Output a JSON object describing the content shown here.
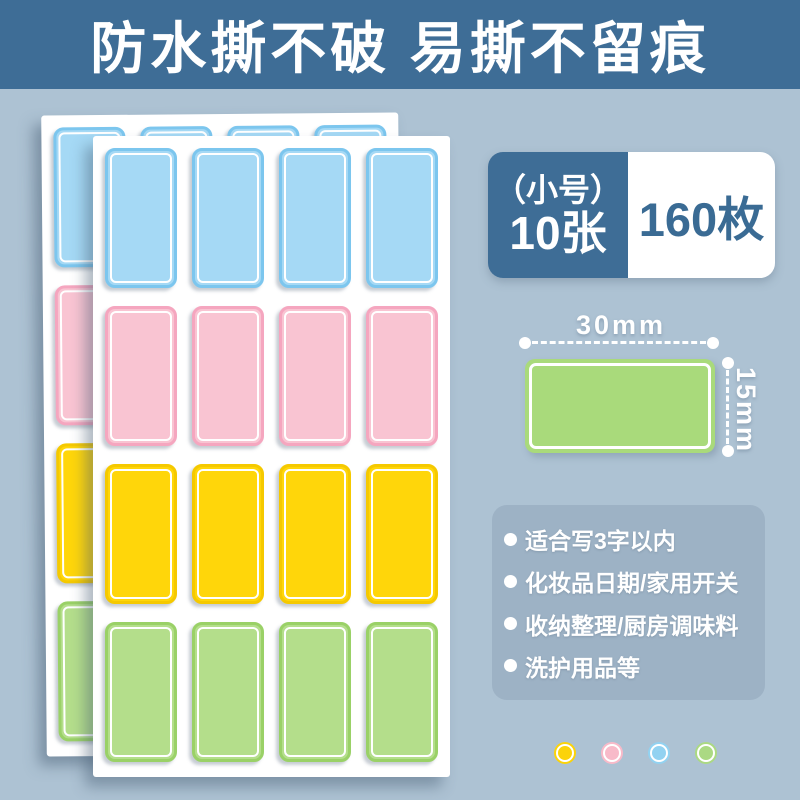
{
  "page": {
    "background": "#adc2d3"
  },
  "header": {
    "title": "防水撕不破 易撕不留痕",
    "background": "#3e6d96",
    "text_color": "#ffffff"
  },
  "sheets": {
    "count": 2,
    "columns": 4,
    "rows": [
      {
        "name": "blue",
        "fill": "#a5d9f5",
        "edge": "#7cc6ee"
      },
      {
        "name": "pink",
        "fill": "#f9c4d2",
        "edge": "#f5a6bf"
      },
      {
        "name": "yellow",
        "fill": "#ffd60a",
        "edge": "#f5c900"
      },
      {
        "name": "green",
        "fill": "#b4de8b",
        "edge": "#9ad167"
      }
    ]
  },
  "size_badge": {
    "size_line1": "（小号）",
    "size_line2": "10张",
    "count_text": "160枚",
    "badge_bg": "#3e6d96",
    "count_color": "#3a6b94"
  },
  "dimension_diagram": {
    "width_label": "30mm",
    "height_label": "15mm",
    "sample_fill": "#a9da7b"
  },
  "features": {
    "box_bg": "#9db2c5",
    "items": [
      "适合写3字以内",
      "化妆品日期/家用开关",
      "收纳整理/厨房调味料",
      "洗护用品等"
    ]
  },
  "color_dots": [
    {
      "name": "yellow",
      "color": "#fbd30a"
    },
    {
      "name": "pink",
      "color": "#f8bac9"
    },
    {
      "name": "blue",
      "color": "#92d2f1"
    },
    {
      "name": "green",
      "color": "#abd983"
    }
  ]
}
